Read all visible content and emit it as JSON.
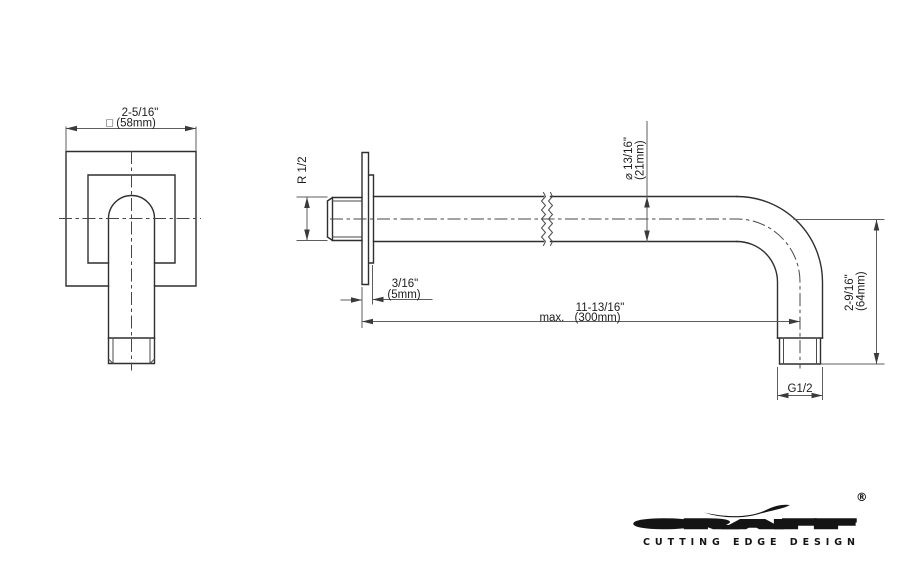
{
  "front_view": {
    "width_inches": "2-5/16\"",
    "width_mm": "□ (58mm)"
  },
  "side_view": {
    "radius": "R 1/2",
    "plate_thickness_inches": "3/16\"",
    "plate_thickness_mm": "(5mm)",
    "diameter_inches": "⌀ 13/16\"",
    "diameter_mm": "(21mm)",
    "length_inches": "11-13/16\"",
    "length_mm": "max. (300mm)",
    "drop_inches": "2-9/16\"",
    "drop_mm": "(64mm)",
    "thread": "G1/2"
  },
  "logo": {
    "brand": "GRAFF",
    "registered": "®",
    "tagline": "CUTTING EDGE DESIGN"
  }
}
